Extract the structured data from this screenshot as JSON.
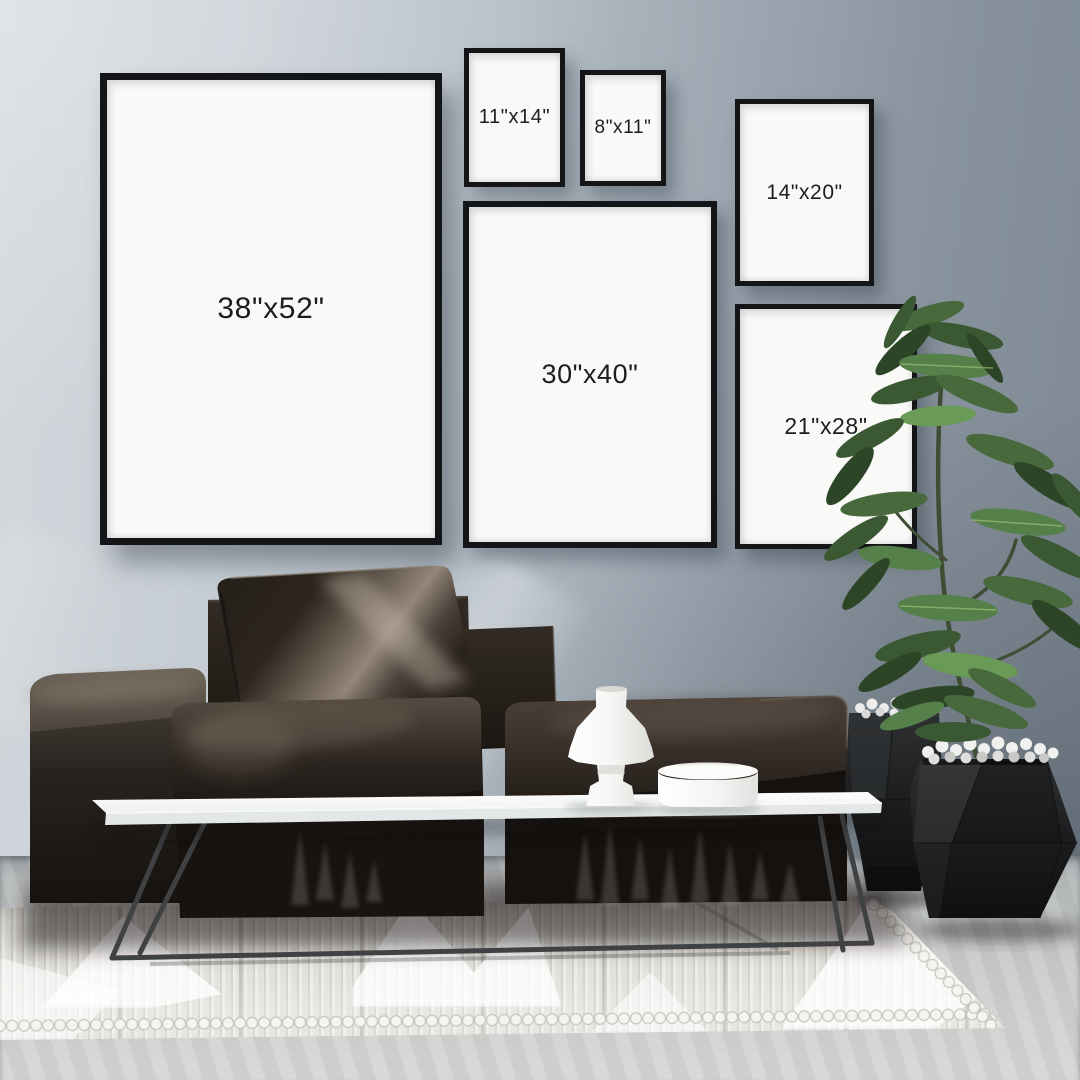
{
  "frames": [
    {
      "id": "38x52",
      "label": "38\"x52\""
    },
    {
      "id": "11x14",
      "label": "11\"x14\""
    },
    {
      "id": "8x11",
      "label": "8\"x11\""
    },
    {
      "id": "14x20",
      "label": "14\"x20\""
    },
    {
      "id": "30x40",
      "label": "30\"x40\""
    },
    {
      "id": "21x28",
      "label": "21\"x28\""
    }
  ],
  "palette": {
    "wall_left": "#d4d9dd",
    "wall_right": "#7d8893",
    "frame_border": "#141518",
    "frame_paper": "#f9f9f7",
    "label_text": "#1d1d1d",
    "sofa": "#241d19",
    "pillow_highlight": "#a99c8f",
    "coffee_table": "#f7f8f8",
    "table_legs": "#3f4143",
    "vase": "#f6f6f4",
    "bowl": "#f4f4f2",
    "rug": "#e7e6e1",
    "floor": "#c9cbca",
    "planters": "#1a1b1d",
    "pebbles": "#ededeb",
    "plant_leaves": "#47693c",
    "plant_trunk": "#3e4d34"
  }
}
